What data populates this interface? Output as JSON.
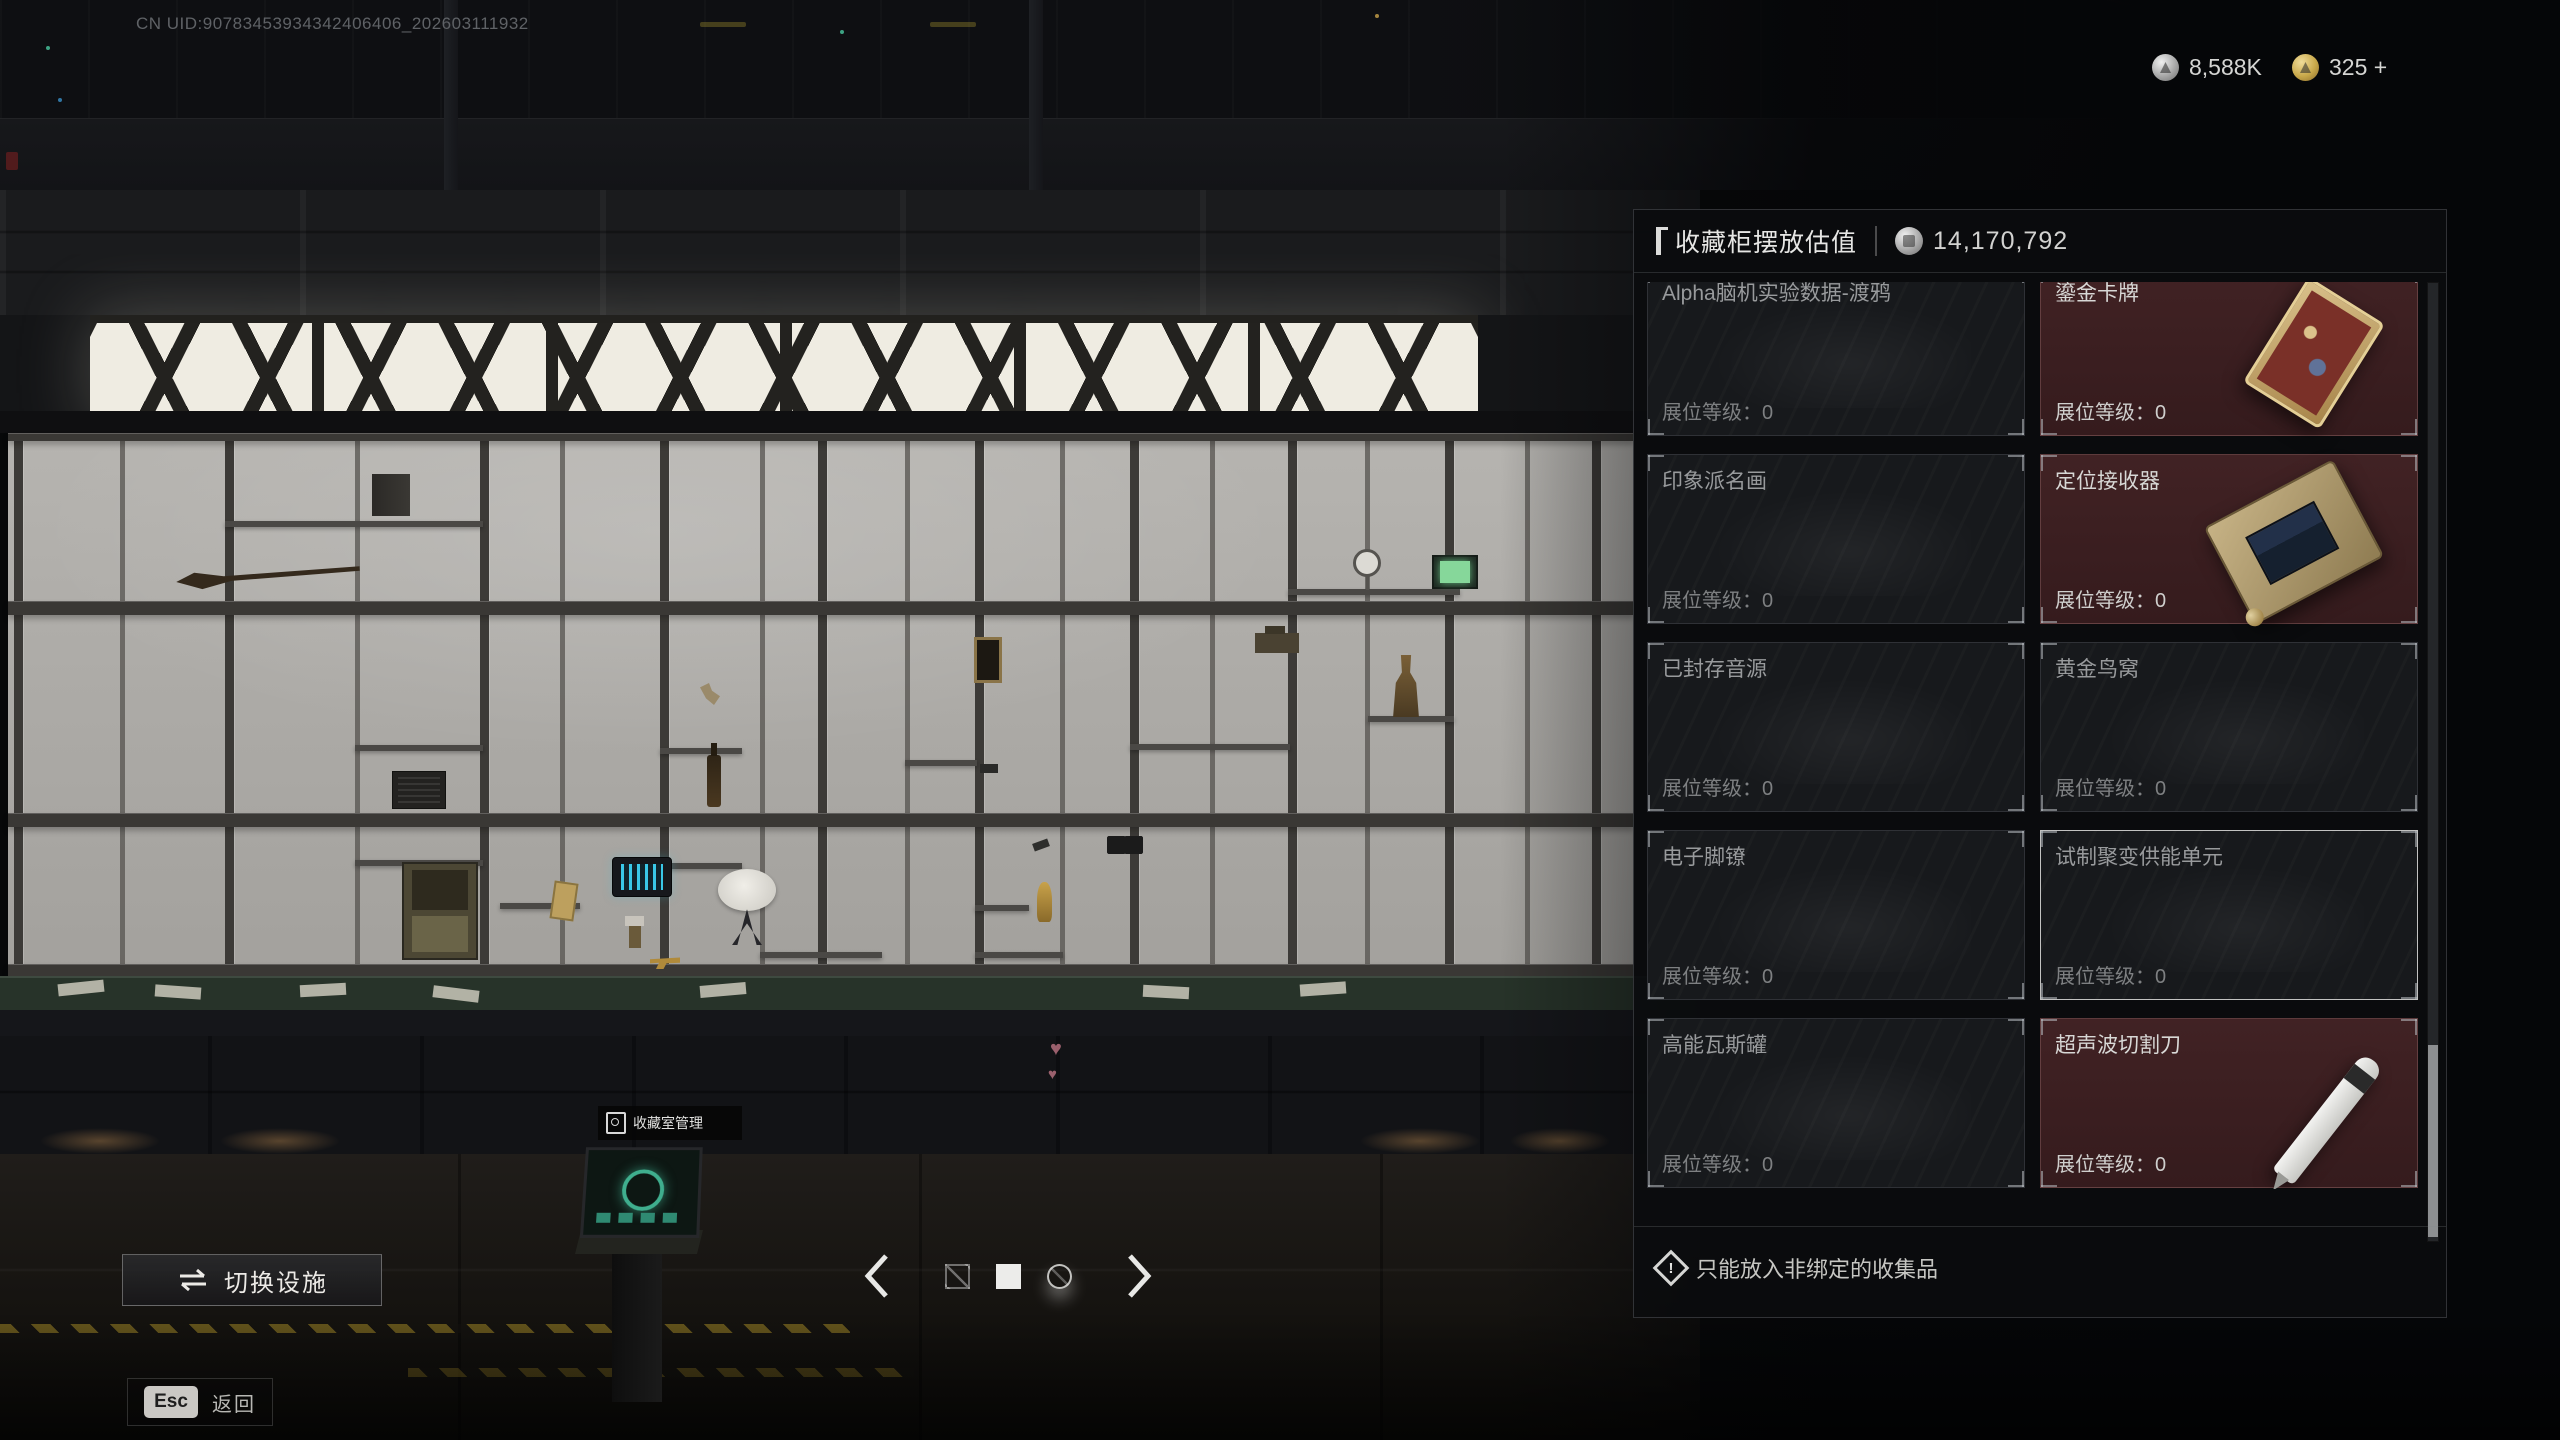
{
  "hud": {
    "uid": "CN UID:90783453934342406406_202603111932",
    "currencies": [
      {
        "icon": "silver-coin",
        "value": "8,588K"
      },
      {
        "icon": "gold-coin",
        "value": "325 +"
      }
    ]
  },
  "panel": {
    "title": "收藏柜摆放估值",
    "value_icon": "silver-coin",
    "total_value": "14,170,792",
    "slot_level_label": "展位等级：",
    "items": [
      {
        "name": "Alpha脑机实验数据-渡鸦",
        "level": "0",
        "state": "empty"
      },
      {
        "name": "鎏金卡牌",
        "level": "0",
        "state": "placed",
        "visual": "gilded-card"
      },
      {
        "name": "印象派名画",
        "level": "0",
        "state": "empty"
      },
      {
        "name": "定位接收器",
        "level": "0",
        "state": "placed",
        "visual": "locator-receiver"
      },
      {
        "name": "已封存音源",
        "level": "0",
        "state": "empty"
      },
      {
        "name": "黄金鸟窝",
        "level": "0",
        "state": "empty"
      },
      {
        "name": "电子脚镣",
        "level": "0",
        "state": "empty"
      },
      {
        "name": "试制聚变供能单元",
        "level": "0",
        "state": "empty-highlighted"
      },
      {
        "name": "高能瓦斯罐",
        "level": "0",
        "state": "empty"
      },
      {
        "name": "超声波切割刀",
        "level": "0",
        "state": "placed",
        "visual": "ultrasonic-cutter"
      }
    ],
    "footer_note": "只能放入非绑定的收集品",
    "footer_icon": "alert-diamond"
  },
  "scene": {
    "terminal_label": "收藏室管理",
    "terminal_icon": "cabinet"
  },
  "footer": {
    "switch_facility": "切换设施",
    "switch_icon": "swap-arrows",
    "esc_key": "Esc",
    "return_label": "返回"
  },
  "pagination": {
    "total_pages": 3,
    "active_page": 2
  },
  "colors": {
    "placed_slot_bg": "#3c1f21",
    "empty_slot_bg": "#17191c",
    "highlight_border": "#e1e1de",
    "terminal_accent": "#3fae8e",
    "gold_accent": "#c8a84a"
  }
}
